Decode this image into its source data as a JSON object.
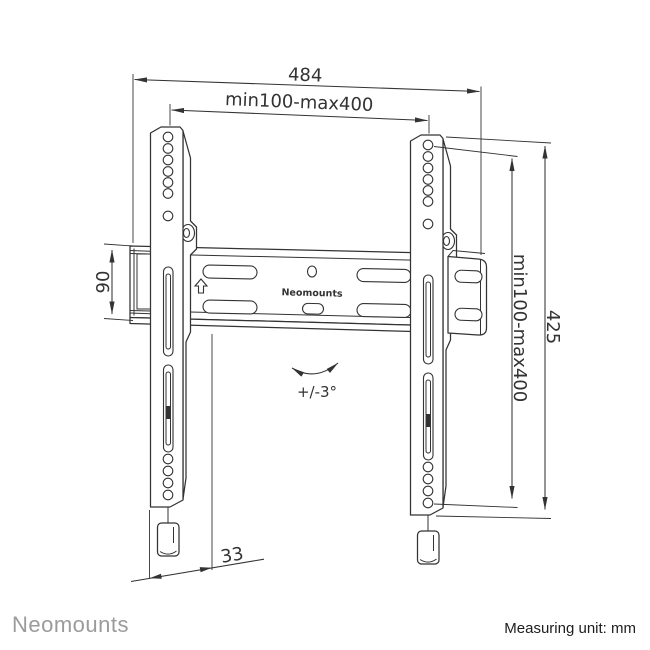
{
  "diagram": {
    "product_label": "Neomounts",
    "dim_total_width": "484",
    "dim_vesa_width": "min100-max400",
    "dim_vesa_height": "min100-max400",
    "dim_total_height": "425",
    "dim_rail_height": "90",
    "dim_wall_depth": "33",
    "dim_tilt": "+/-3°",
    "colors": {
      "line": "#333333",
      "brand_gray": "#9b9b9b",
      "footer_text": "#1d1d1d"
    }
  },
  "footer": {
    "brand": "Neomounts",
    "measuring_unit": "Measuring unit: mm"
  }
}
